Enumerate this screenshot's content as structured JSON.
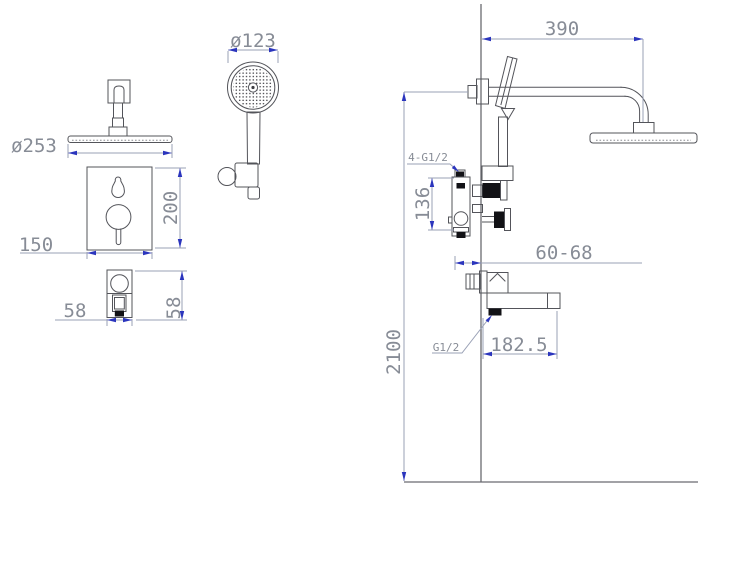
{
  "drawing": {
    "type": "technical-installation-drawing",
    "subject": "concealed shower system with rain head, hand shower, mixer valve and tub spout",
    "colors": {
      "outline": "#53545a",
      "dimension_line": "#9aa1b6",
      "arrow": "#2b35bd",
      "dimension_text": "#878c96",
      "background": "#ffffff"
    },
    "views": {
      "rain_shower": {
        "diameter_label": "ø253"
      },
      "hand_shower": {
        "diameter_label": "ø123"
      },
      "mixer_panel": {
        "width_label": "150",
        "height_label": "200"
      },
      "spout_end": {
        "width_label": "58",
        "height_label": "58"
      },
      "installation": {
        "arm_length_label": "390",
        "height_label": "2100",
        "valve_span_label": "136",
        "embed_depth_label": "60-68",
        "spout_length_label": "182.5",
        "inlet_ports_label": "4-G1/2",
        "spout_port_label": "G1/2"
      }
    }
  }
}
